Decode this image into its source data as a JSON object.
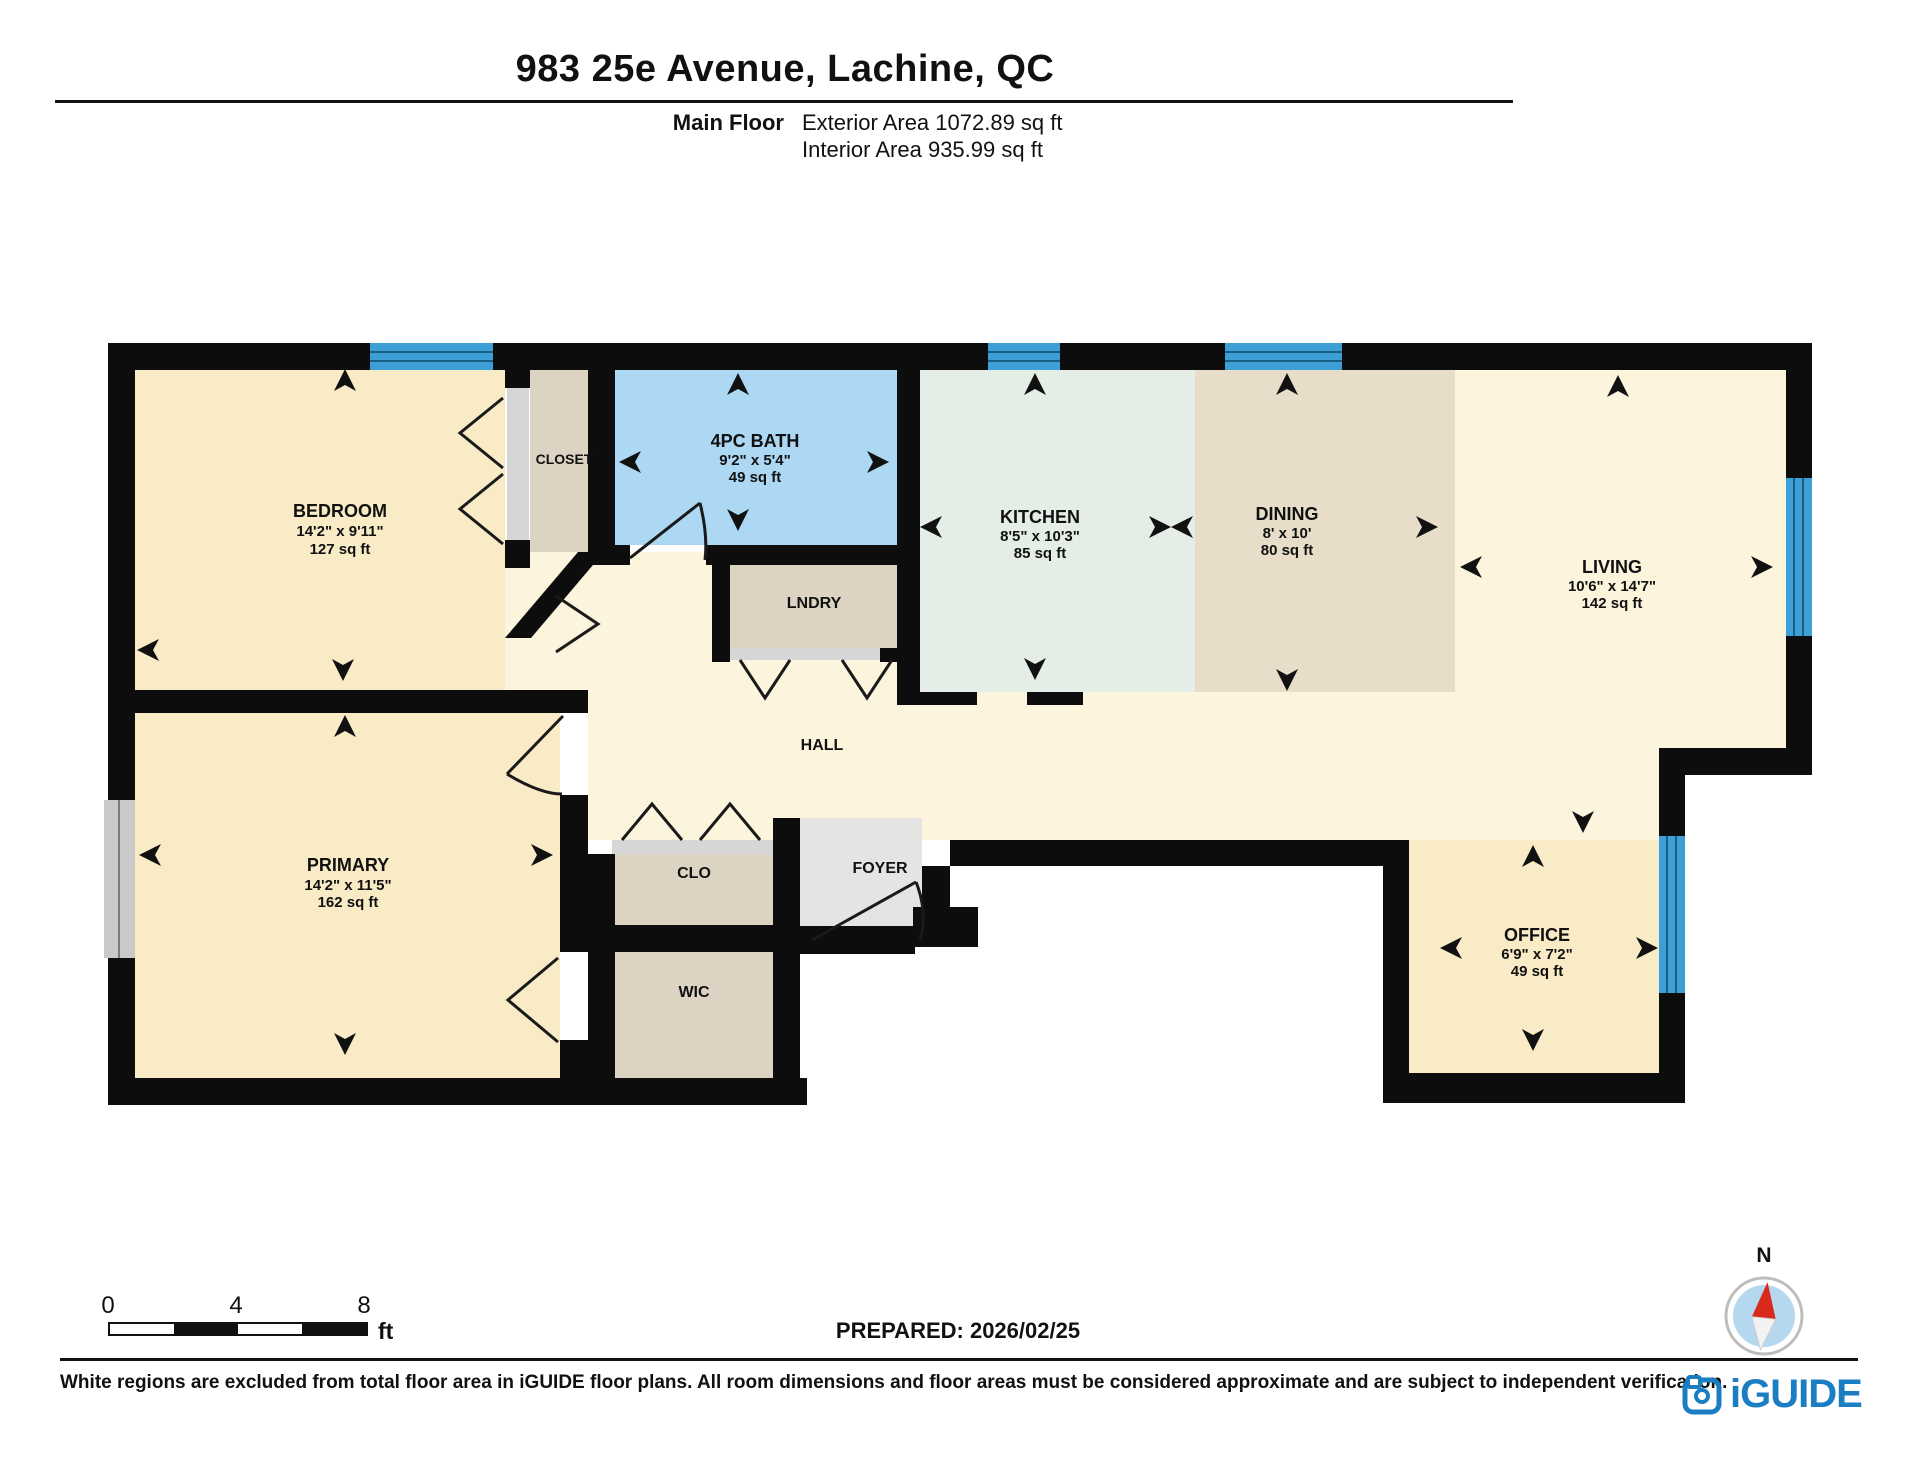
{
  "header": {
    "title": "983 25e Avenue, Lachine, QC",
    "floor_label": "Main Floor",
    "exterior_area": "Exterior Area 1072.89 sq ft",
    "interior_area": "Interior Area 935.99 sq ft"
  },
  "rooms": {
    "bedroom": {
      "name": "BEDROOM",
      "dims": "14'2\" x 9'11\"",
      "area": "127 sq ft"
    },
    "closet": {
      "name": "CLOSET"
    },
    "bath": {
      "name": "4PC BATH",
      "dims": "9'2\" x 5'4\"",
      "area": "49 sq ft"
    },
    "lndry": {
      "name": "LNDRY"
    },
    "kitchen": {
      "name": "KITCHEN",
      "dims": "8'5\" x 10'3\"",
      "area": "85 sq ft"
    },
    "dining": {
      "name": "DINING",
      "dims": "8' x 10'",
      "area": "80 sq ft"
    },
    "living": {
      "name": "LIVING",
      "dims": "10'6\" x 14'7\"",
      "area": "142 sq ft"
    },
    "hall": {
      "name": "HALL"
    },
    "primary": {
      "name": "PRIMARY",
      "dims": "14'2\" x 11'5\"",
      "area": "162 sq ft"
    },
    "clo": {
      "name": "CLO"
    },
    "wic": {
      "name": "WIC"
    },
    "foyer": {
      "name": "FOYER"
    },
    "office": {
      "name": "OFFICE",
      "dims": "6'9\" x 7'2\"",
      "area": "49 sq ft"
    }
  },
  "scale": {
    "t0": "0",
    "t4": "4",
    "t8": "8",
    "unit": "ft"
  },
  "prepared": "PREPARED: 2026/02/25",
  "compass": {
    "label": "N"
  },
  "footer": {
    "disclaimer": "White regions are excluded from total floor area in iGUIDE floor plans. All room dimensions and floor areas must be considered approximate and are subject to independent verification.",
    "logo_text": "iGUIDE"
  },
  "colors": {
    "wall": "#0d0d0d",
    "window_blue": "#3E9ED6",
    "window_line": "#1A5E85",
    "bedroom_fill": "#F8EBC5",
    "hall_fill": "#FCF4DC",
    "kitchen_fill": "#E4EEE6",
    "dining_fill": "#E7DDC9",
    "bath_fill": "#ACD8F3",
    "closet_fill": "#DCD3C2",
    "foyer_fill": "#E4E4E3",
    "sill_gray": "#D6D6D6",
    "logo_blue": "#1B7EC3",
    "compass_red": "#D8291D"
  }
}
